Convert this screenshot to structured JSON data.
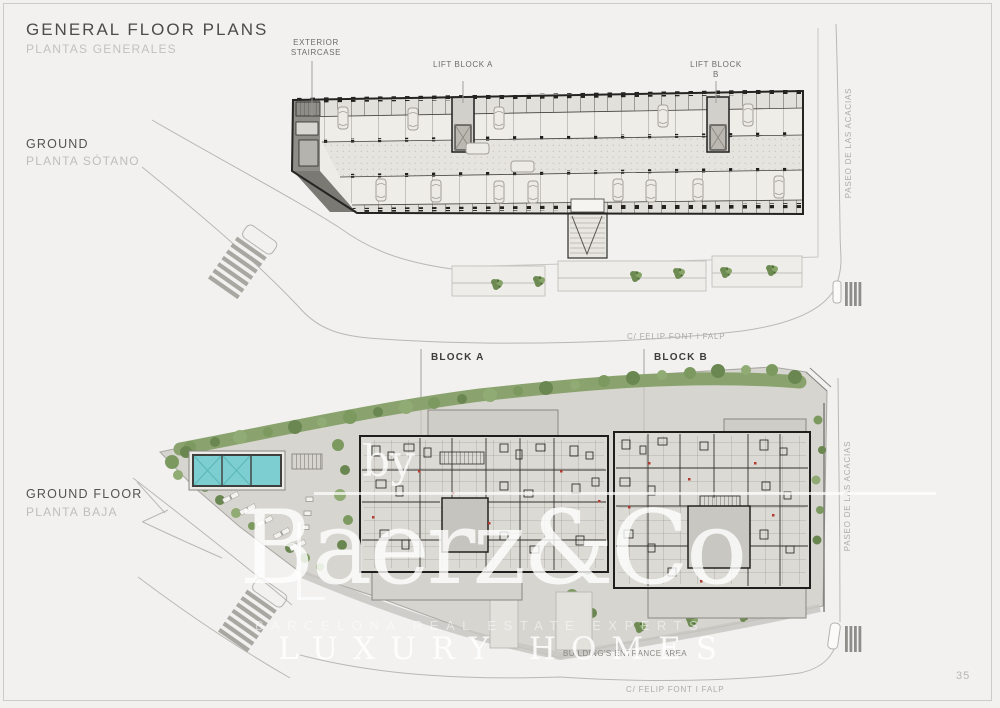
{
  "header": {
    "title": "GENERAL FLOOR PLANS",
    "subtitle": "PLANTAS GENERALES"
  },
  "upper_plan": {
    "label": "GROUND",
    "label_secondary": "PLANTA SÓTANO",
    "annotation_staircase": "EXTERIOR STAIRCASE",
    "annotation_lift_a": "LIFT BLOCK A",
    "annotation_lift_b": "LIFT BLOCK B",
    "street_side": "PASEO DE LAS ACACIAS",
    "street_bottom": "C/ FELIP FONT I FALP"
  },
  "lower_plan": {
    "label": "GROUND FLOOR",
    "label_secondary": "PLANTA BAJA",
    "block_a": "BLOCK A",
    "block_b": "BLOCK B",
    "street_side": "PASEO DE LAS ACACIAS",
    "street_bottom": "C/ FELIP FONT I FALP",
    "entrance_note": "BUILDING'S ENTRANCE AREA"
  },
  "watermark": {
    "prefix": "by",
    "brand": "Baerz&Co",
    "tagline": "BARCELONA REAL ESTATE EXPERTS",
    "brand_secondary": "LUXURY HOMES"
  },
  "page": {
    "number": "35"
  },
  "colors": {
    "landscape_green": "#7d9a5e",
    "pool_teal": "#7cced0",
    "wall_dark": "#23221f",
    "accent_red": "#b23a2e",
    "paper": "#f2f1ef"
  }
}
